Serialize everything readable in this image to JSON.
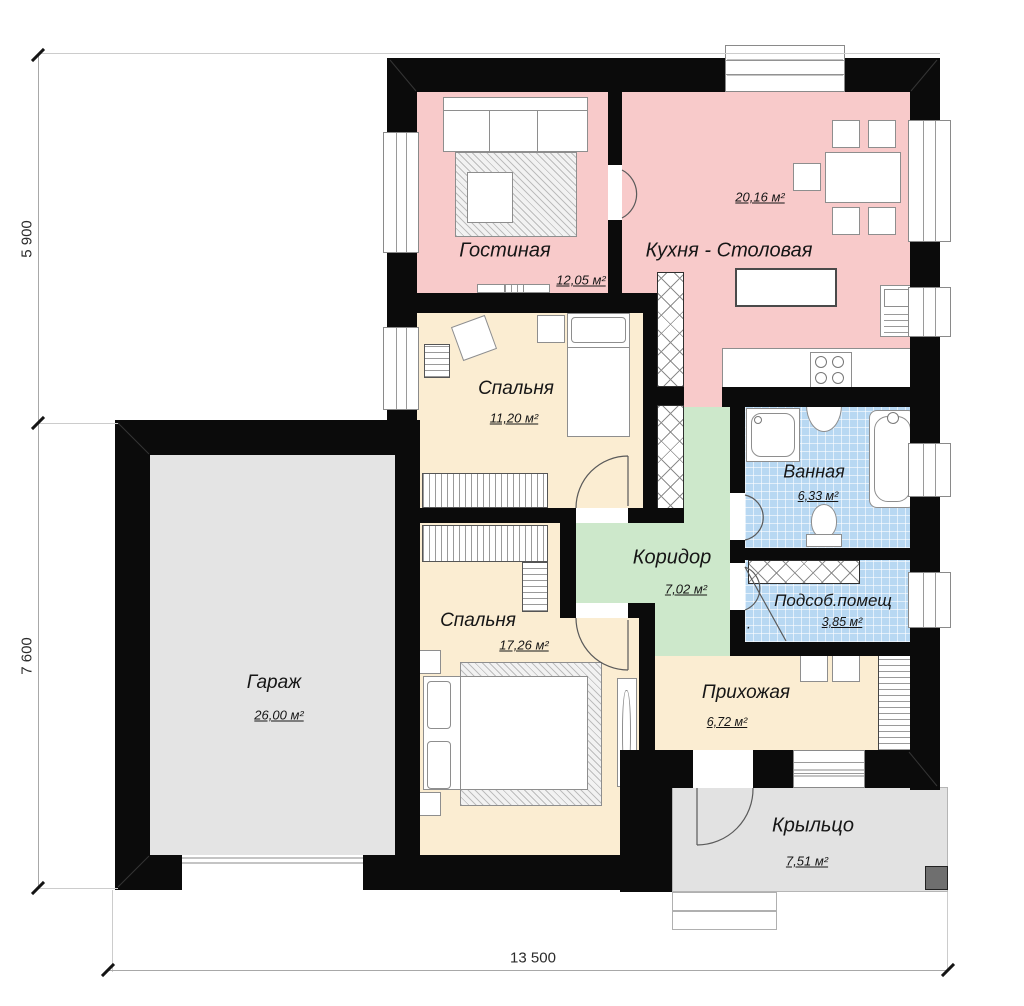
{
  "plan_title": "План 1-го этажа",
  "colors": {
    "wall": "#0b0b0b",
    "living_kitchen_pink": "#f8caca",
    "bedroom_beige": "#fbedd2",
    "corridor_green": "#cde8cb",
    "wet_blue": "#b8d8f2",
    "garage_gray": "#e4e4e4",
    "porch_gray": "#e2e2e2",
    "porch_block_gray": "#6f6f6f"
  },
  "dimensions": {
    "bottom": "13 500",
    "left_upper": "5 900",
    "left_lower": "7 600"
  },
  "rooms": [
    {
      "name": "Гостиная",
      "area": "12,05 м²",
      "color": "#f8caca"
    },
    {
      "name": "Кухня - Столовая",
      "area": "20,16 м²",
      "color": "#f8caca"
    },
    {
      "name": "Спальня",
      "area": "11,20 м²",
      "color": "#fbedd2"
    },
    {
      "name": "Спальня",
      "area": "17,26 м²",
      "color": "#fbedd2"
    },
    {
      "name": "Гараж",
      "area": "26,00 м²",
      "color": "#e4e4e4"
    },
    {
      "name": "Ванная",
      "area": "6,33 м²",
      "color": "#b8d8f2"
    },
    {
      "name": "Коридор",
      "area": "7,02 м²",
      "color": "#cde8cb"
    },
    {
      "name": "Подсоб.помещ",
      "period": ".",
      "area": "3,85 м²",
      "color": "#b8d8f2"
    },
    {
      "name": "Прихожая",
      "area": "6,72 м²",
      "color": "#fbedd2"
    },
    {
      "name": "Крыльцо",
      "area": "7,51 м²",
      "color": "#e2e2e2"
    }
  ]
}
